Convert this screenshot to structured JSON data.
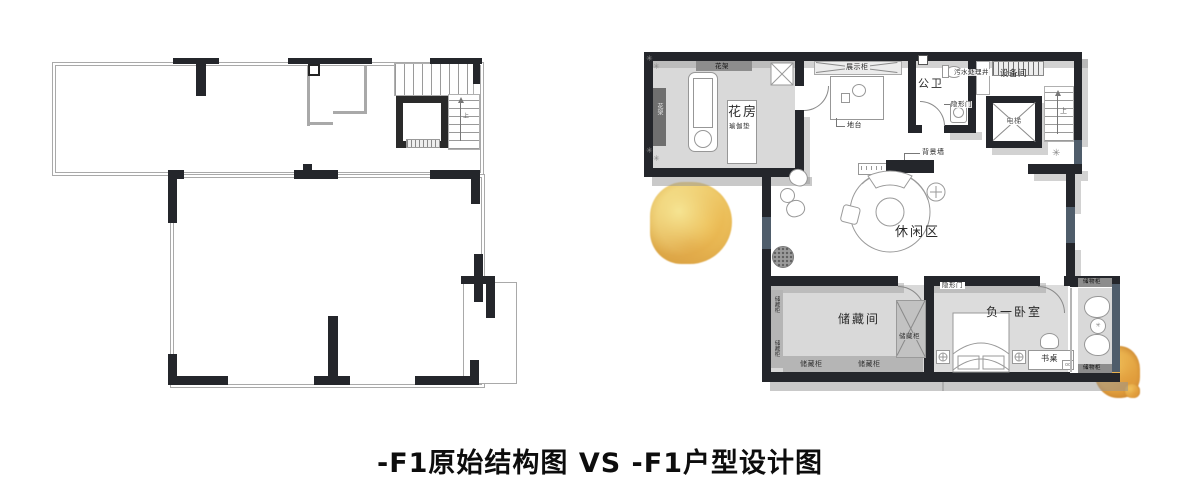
{
  "caption": {
    "title": "-F1原始结构图 VS -F1户型设计图"
  },
  "colors": {
    "wall_dark": "#24262b",
    "window_blue_gray": "#4f5d6b",
    "floor_gray": "#d9d9d9",
    "cabinet_gray": "#8d8d8d",
    "shadow_gray": "#969696",
    "thin_wall_gray": "#a9a9a9",
    "tree_yellow": "#ecba50",
    "tree_orange": "#dd9434"
  },
  "left_plan": {
    "stairs_up": "上"
  },
  "right_plan": {
    "labels": {
      "flower_rack": "花架",
      "flower_room": "花房",
      "yoga_mat": "瑜伽垫",
      "display_cabinet": "展示柜",
      "platform": "地台",
      "public_bathroom": "公卫",
      "sewage_well": "污水处理井",
      "equipment_room": "设备间",
      "hidden_door": "隐形门",
      "elevator": "电梯",
      "stairs_up": "上",
      "background_wall": "背景墙",
      "leisure_area": "休闲区",
      "storage_room": "储藏间",
      "storage_cabinet": "储藏柜",
      "basement_bedroom": "负一卧室",
      "desk": "书桌",
      "locker_cabinet": "储物柜"
    }
  }
}
